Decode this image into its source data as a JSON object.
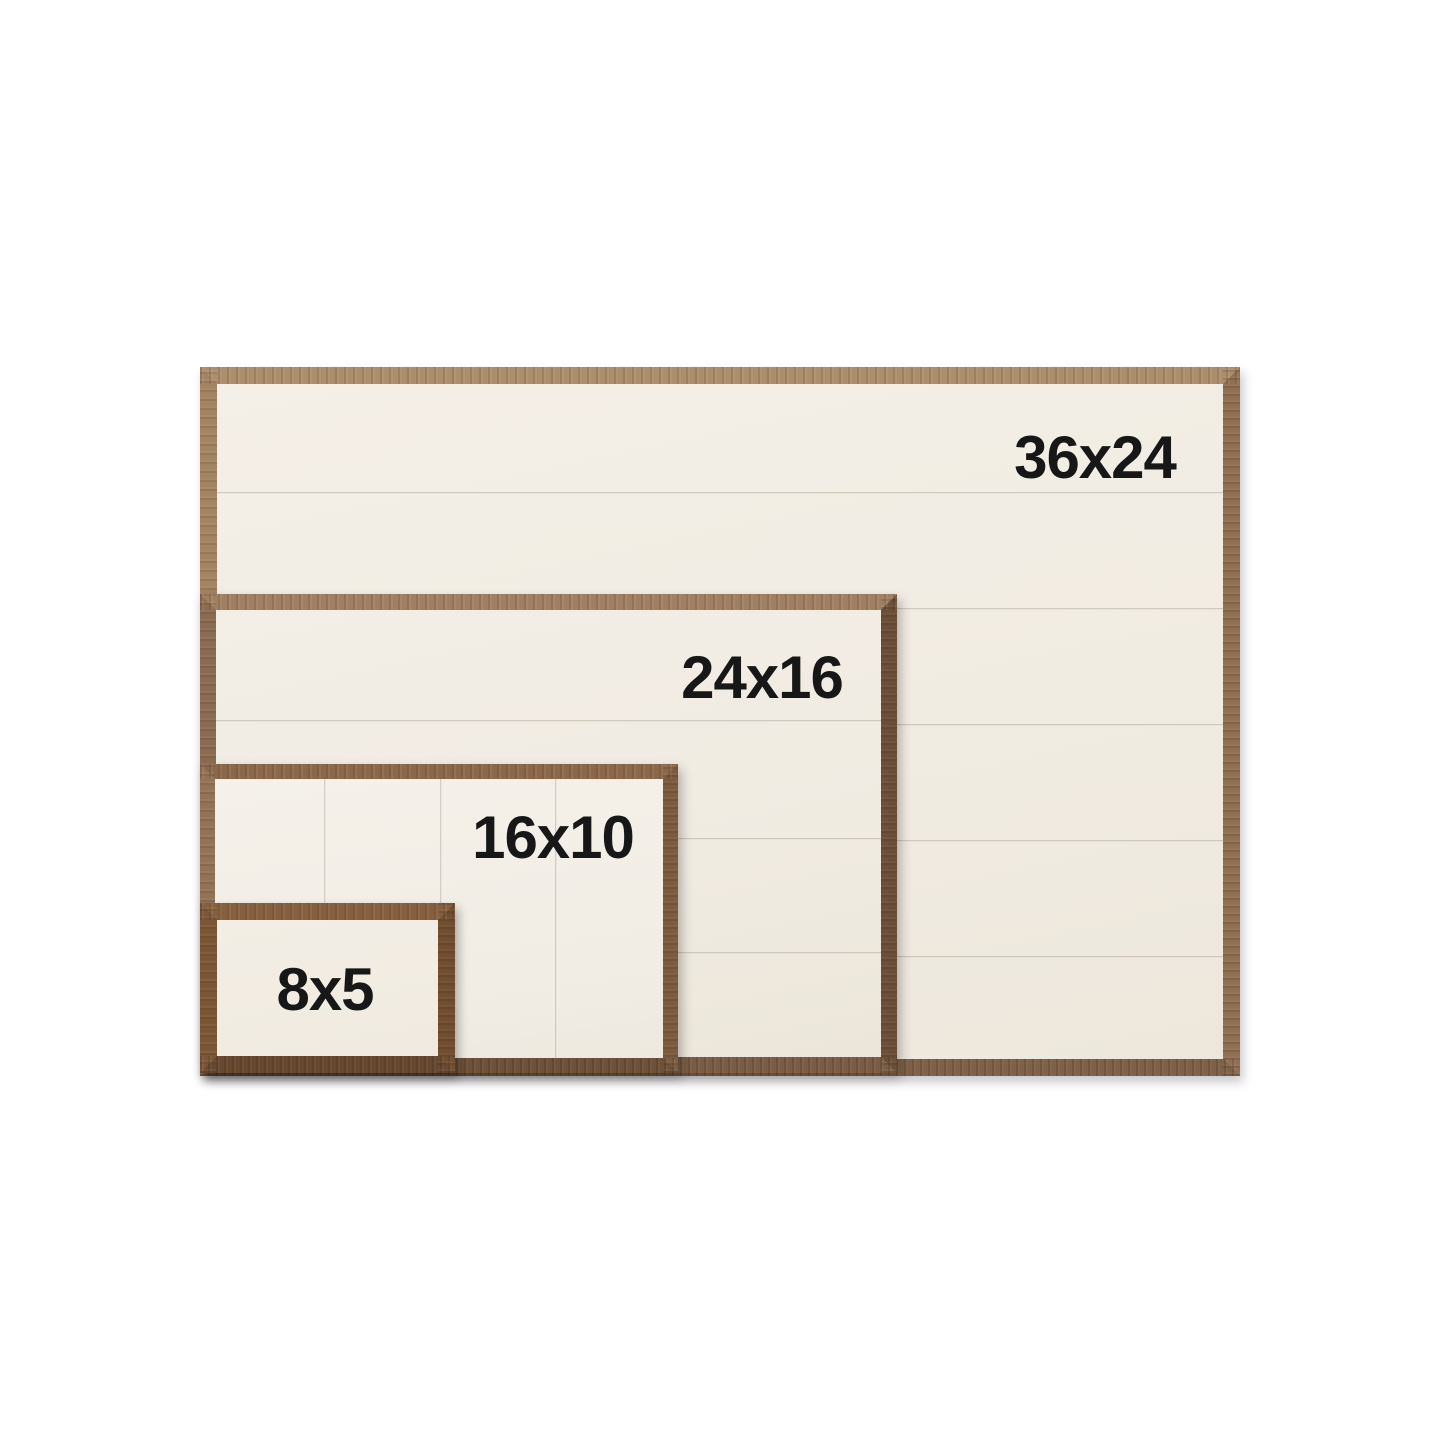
{
  "background_color": "#ffffff",
  "label_color": "#171717",
  "panel_color": "#f2ede4",
  "seam_color": "#7d7261",
  "frames": [
    {
      "id": "36x24",
      "label": "36x24",
      "width_in": 36,
      "height_in": 24,
      "plank_direction": "horizontal",
      "plank_seam_count": 5,
      "wood": {
        "top": "#ab8e6b",
        "right": "#8f7052",
        "bottom": "#7d6148",
        "left": "#a18462"
      }
    },
    {
      "id": "24x16",
      "label": "24x16",
      "width_in": 24,
      "height_in": 16,
      "plank_direction": "horizontal",
      "plank_seam_count": 3,
      "wood": {
        "top": "#a08063",
        "right": "#6b4f37",
        "bottom": "#7a5d45",
        "left": "#8a6c51"
      }
    },
    {
      "id": "16x10",
      "label": "16x10",
      "width_in": 16,
      "height_in": 10,
      "plank_direction": "vertical",
      "plank_seam_count": 3,
      "wood": {
        "top": "#8c684b",
        "right": "#7b5c3f",
        "bottom": "#6d5138",
        "left": "#927356"
      }
    },
    {
      "id": "8x5",
      "label": "8x5",
      "width_in": 8,
      "height_in": 5,
      "plank_direction": "none",
      "plank_seam_count": 0,
      "wood": {
        "top": "#85603e",
        "right": "#714e2f",
        "bottom": "#674830",
        "left": "#7a5637"
      }
    }
  ]
}
